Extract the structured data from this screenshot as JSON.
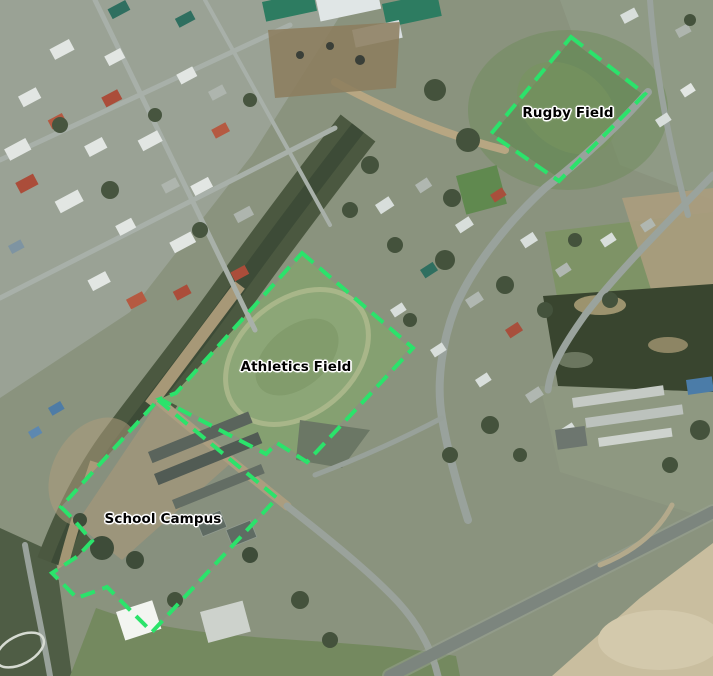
{
  "map": {
    "basemap_type": "aerial-imagery",
    "overlay": {
      "stroke_color": "#2be36b",
      "stroke_width": 4,
      "dash_pattern": "15 8",
      "label_text_color": "#000000",
      "label_halo_color": "#ffffff",
      "features": [
        {
          "id": "rugby-field",
          "label": "Rugby Field",
          "label_x": 568,
          "label_y": 113,
          "points": "571,37 645,94 559,181 491,134"
        },
        {
          "id": "athletics-field",
          "label": "Athletics Field",
          "label_x": 296,
          "label_y": 367,
          "points": "302,253 413,348 307,462 277,443 266,454 160,399 176,393"
        },
        {
          "id": "school-campus",
          "label": "School Campus",
          "label_x": 163,
          "label_y": 519,
          "points": "158,400 277,498 152,632 107,587 77,598 52,573 78,556 92,541 73,519 61,507"
        }
      ]
    }
  }
}
